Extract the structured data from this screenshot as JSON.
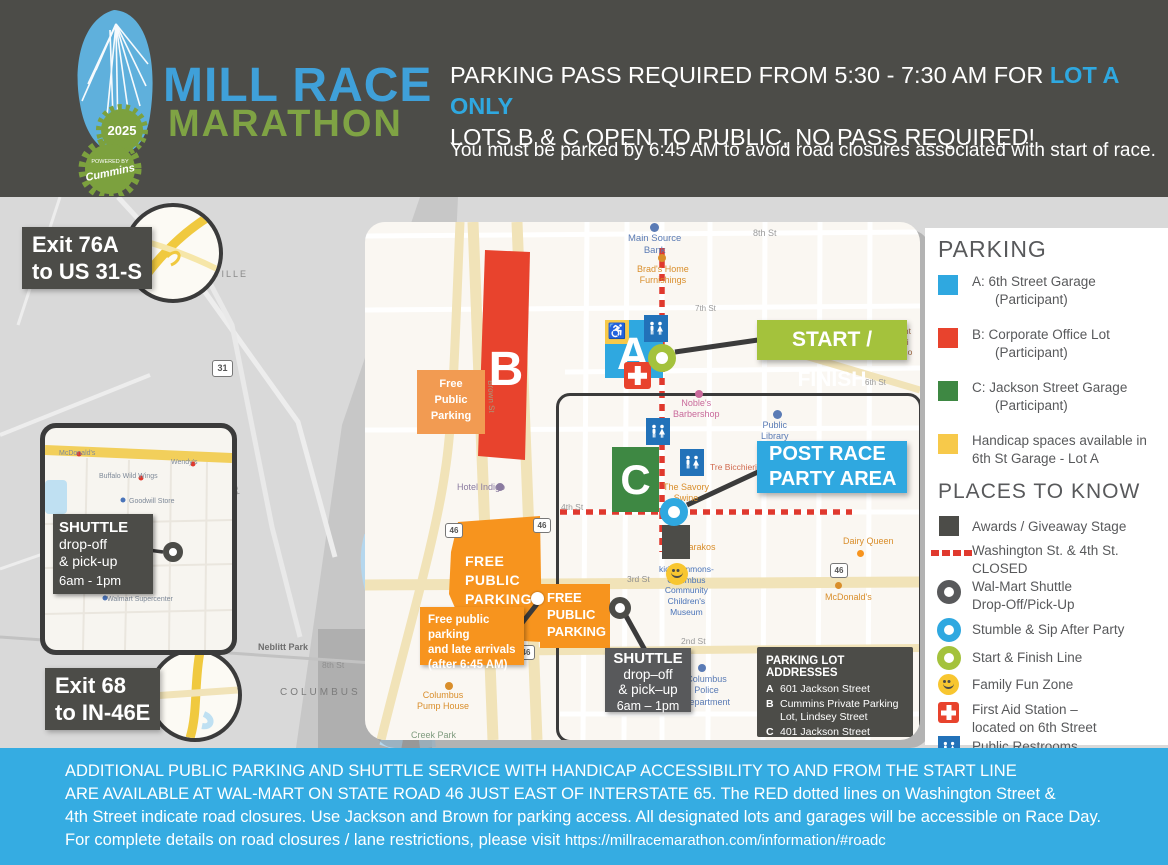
{
  "header": {
    "line1_prefix": "PARKING PASS REQUIRED FROM 5:30 - 7:30 AM FOR ",
    "line1_highlight": "LOT A ONLY",
    "line2": "LOTS B & C OPEN TO PUBLIC, NO PASS REQUIRED!",
    "note": "You must be parked by 6:45 AM to avoid road closures associated with start of race."
  },
  "logo": {
    "title_line1": "MILL RACE",
    "title_line2": "MARATHON",
    "year": "2025",
    "sponsor_prefix": "POWERED BY",
    "sponsor": "Cummins"
  },
  "icons": {
    "handicap": "♿"
  },
  "map": {
    "exit76a": "Exit 76A\nto US 31-S",
    "exit68": "Exit 68\nto IN-46E",
    "bg": {
      "orsville": "ORSVILLE",
      "route31": "31",
      "indianapolis_rd": "N Indianapolis Rd",
      "neblitt": "Neblitt Park",
      "columbus": "COLUMBUS",
      "eighth": "8th St"
    },
    "walmart": {
      "mcdonalds": "McDonald's",
      "wendys": "Wendy's",
      "bww": "Buffalo Wild Wings",
      "goodwill": "Goodwill Store",
      "walmart": "Walmart Supercenter",
      "shuttle_title": "SHUTTLE",
      "shuttle_lines": "drop-off\n& pick-up",
      "shuttle_time": "6am - 1pm"
    },
    "inset": {
      "lot_a": "A",
      "lot_b": "B",
      "lot_c": "C",
      "start_finish": "START / FINISH",
      "post_race": "POST RACE\nPARTY AREA",
      "free_parking_small": "Free\nPublic\nParking",
      "free_parking_big": "FREE\nPUBLIC\nPARKING",
      "late_arrivals": "Free public parking\nand late arrivals\n(after 6:45 AM)",
      "shuttle_title": "SHUTTLE",
      "shuttle_lines": "drop–off\n& pick–up",
      "shuttle_time": "6am – 1pm",
      "addresses_title": "PARKING LOT ADDRESSES",
      "addresses": [
        {
          "key": "A",
          "value": "601 Jackson Street"
        },
        {
          "key": "B",
          "value": "Cummins Private Parking\nLot, Lindsey Street"
        },
        {
          "key": "C",
          "value": "401 Jackson Street"
        }
      ],
      "labels": {
        "main_source": "Main Source\nBank",
        "eighth": "8th St",
        "brads": "Brad's Home\nFurnishings",
        "seventh": "7th St",
        "central": "Cent\nJuni\nScho",
        "sixth": "6th St",
        "nobles": "Noble's\nBarbershop",
        "library": "Public\nLibrary",
        "tre": "Tre Bicchieri",
        "savory": "The Savory\nSwine",
        "fourth": "4th St",
        "zaharakos": "Zaharakos",
        "dairy": "Dairy Queen",
        "kidscommons": "kidscommons-\nColumbus\nCommunity\nChildren's\nMuseum",
        "third": "3rd St",
        "mcdonalds": "McDonald's",
        "second": "2nd St",
        "police": "Columbus\nPolice\nDepartment",
        "hotel": "Hotel Indigo",
        "pump": "Columbus\nPump House",
        "creek": "Creek Park",
        "brown": "Brown St",
        "route46": "46"
      }
    }
  },
  "legend": {
    "parking_title": "PARKING",
    "parking_items": [
      {
        "text": "A:  6th Street Garage\n(Participant)",
        "color": "#2FA8E0"
      },
      {
        "text": "B:  Corporate Office Lot\n(Participant)",
        "color": "#E8432D"
      },
      {
        "text": "C:  Jackson Street Garage\n(Participant)",
        "color": "#3E8843"
      },
      {
        "text": "Handicap spaces available in\n6th St Garage - Lot A",
        "color": "#F7C94A"
      }
    ],
    "places_title": "PLACES TO KNOW",
    "places_items": [
      {
        "text": "Awards / Giveaway Stage"
      },
      {
        "text": "Washington St. & 4th St.\nCLOSED"
      },
      {
        "text": "Wal-Mart Shuttle\nDrop-Off/Pick-Up"
      },
      {
        "text": "Stumble & Sip After Party"
      },
      {
        "text": "Start & Finish Line"
      },
      {
        "text": "Family Fun Zone"
      },
      {
        "text": "First Aid Station –\nlocated on 6th Street"
      },
      {
        "text": "Public Restrooms"
      }
    ]
  },
  "footer": {
    "line1": "ADDITIONAL PUBLIC PARKING AND SHUTTLE SERVICE WITH HANDICAP ACCESSIBILITY TO AND FROM THE START LINE",
    "line2": "ARE AVAILABLE AT WAL-MART ON STATE ROAD 46 JUST EAST OF INTERSTATE 65. The RED dotted lines on Washington Street &",
    "line3": "4th Street indicate road closures. Use Jackson and Brown for parking access. All designated lots and garages will be accessible on Race Day.",
    "line4_prefix": "For complete details on road closures / lane restrictions, please visit ",
    "line4_url": "https://millracemarathon.com/information/#roadc"
  },
  "colors": {
    "accent_blue": "#2FA8E0",
    "lot_red": "#E8432D",
    "lot_green": "#3E8843",
    "handicap_yellow": "#F7C94A",
    "start_green": "#A4C23C",
    "parking_orange": "#F7941E",
    "dark_gray": "#4C4C48",
    "road_closed_red": "#E0392E",
    "banner_blue": "#35ACE2"
  }
}
